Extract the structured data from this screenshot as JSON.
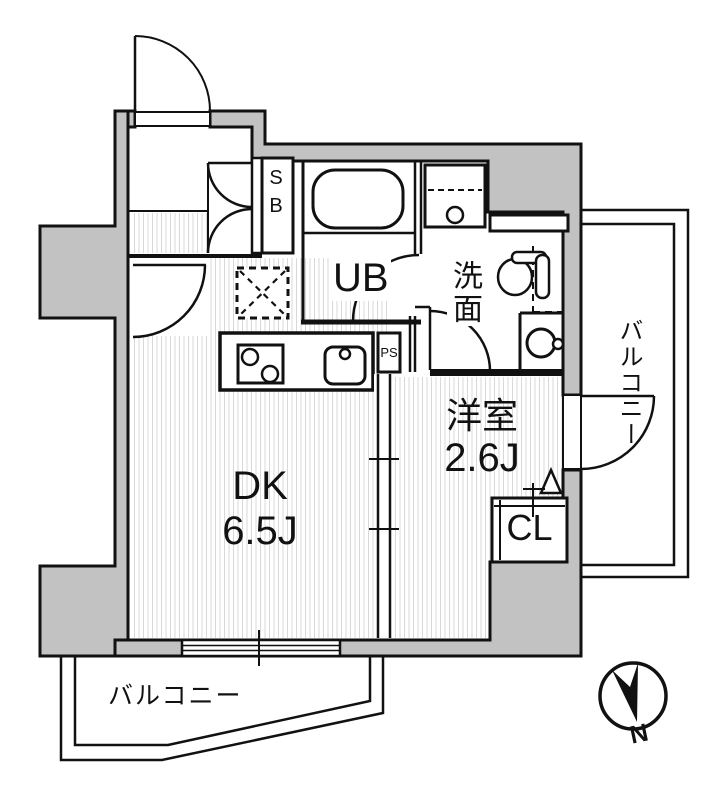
{
  "floorplan": {
    "rooms": {
      "dk": {
        "name": "DK",
        "size": "6.5J"
      },
      "western_room": {
        "name": "洋室",
        "size": "2.6J"
      },
      "unit_bath": {
        "name": "UB"
      },
      "washroom": {
        "name": "洗面"
      },
      "closet": {
        "name": "CL"
      },
      "shoe_box": {
        "name": "SB"
      },
      "pipe_space": {
        "name": "PS"
      },
      "balcony_right": {
        "name": "バルコニー"
      },
      "balcony_bottom": {
        "name": "バルコニー"
      }
    },
    "compass": {
      "label": "N"
    },
    "colors": {
      "wall": "#c2c2c2",
      "line": "#111111",
      "stripe": "#d8d8d8",
      "bg": "#ffffff"
    }
  }
}
